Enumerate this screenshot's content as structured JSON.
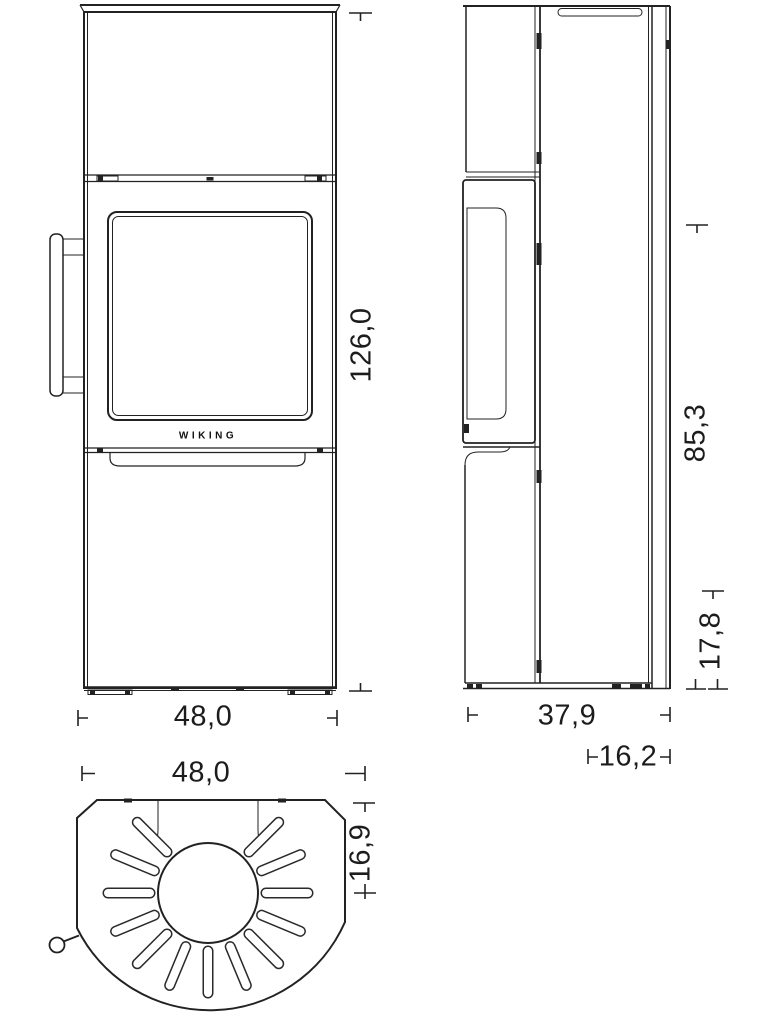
{
  "brand_logo": "WIKING",
  "dimensions": {
    "front_height": "126,0",
    "front_width": "48,0",
    "side_upper_height": "85,3",
    "side_lower_height": "17,8",
    "side_depth": "37,9",
    "side_rear_offset": "16,2",
    "top_width": "48,0",
    "top_flue_offset": "16,9"
  },
  "colors": {
    "line": "#222222",
    "background": "#ffffff"
  }
}
